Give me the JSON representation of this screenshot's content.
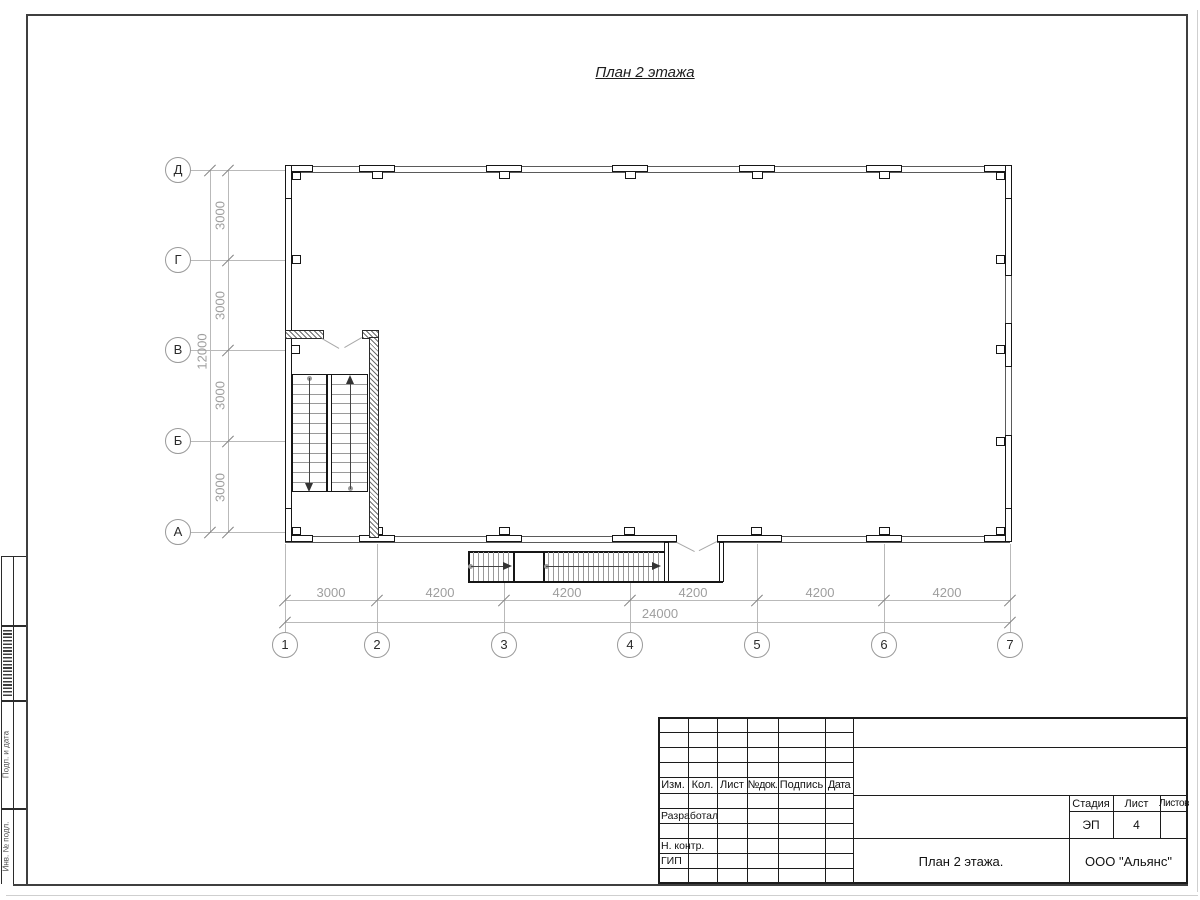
{
  "title": "План 2 этажа",
  "plan": {
    "horizontal_axes": [
      "Д",
      "Г",
      "В",
      "Б",
      "А"
    ],
    "vertical_axes": [
      "1",
      "2",
      "3",
      "4",
      "5",
      "6",
      "7"
    ],
    "dims_left": [
      "3000",
      "3000",
      "3000",
      "3000"
    ],
    "dim_left_total": "12000",
    "dims_bottom": [
      "3000",
      "4200",
      "4200",
      "4200",
      "4200",
      "4200"
    ],
    "dim_bottom_total": "24000"
  },
  "title_block": {
    "header_cells": [
      "Изм.",
      "Кол.",
      "Лист",
      "№док.",
      "Подпись",
      "Дата"
    ],
    "row_labels": [
      "Разработал",
      "Н. контр.",
      "ГИП"
    ],
    "stage_header": [
      "Стадия",
      "Лист",
      "Листов"
    ],
    "stage_value": "ЭП",
    "sheet_value": "4",
    "doc_title": "План 2 этажа.",
    "company": "ООО \"Альянс\""
  },
  "side_stamp": {
    "labels": [
      "Подп. и дата",
      "Инв. № подл."
    ]
  },
  "colors": {
    "wall": "#161616",
    "thin_wall": "#555555",
    "dim": "#b9b9b9",
    "dim_text": "#9e9e9e"
  }
}
